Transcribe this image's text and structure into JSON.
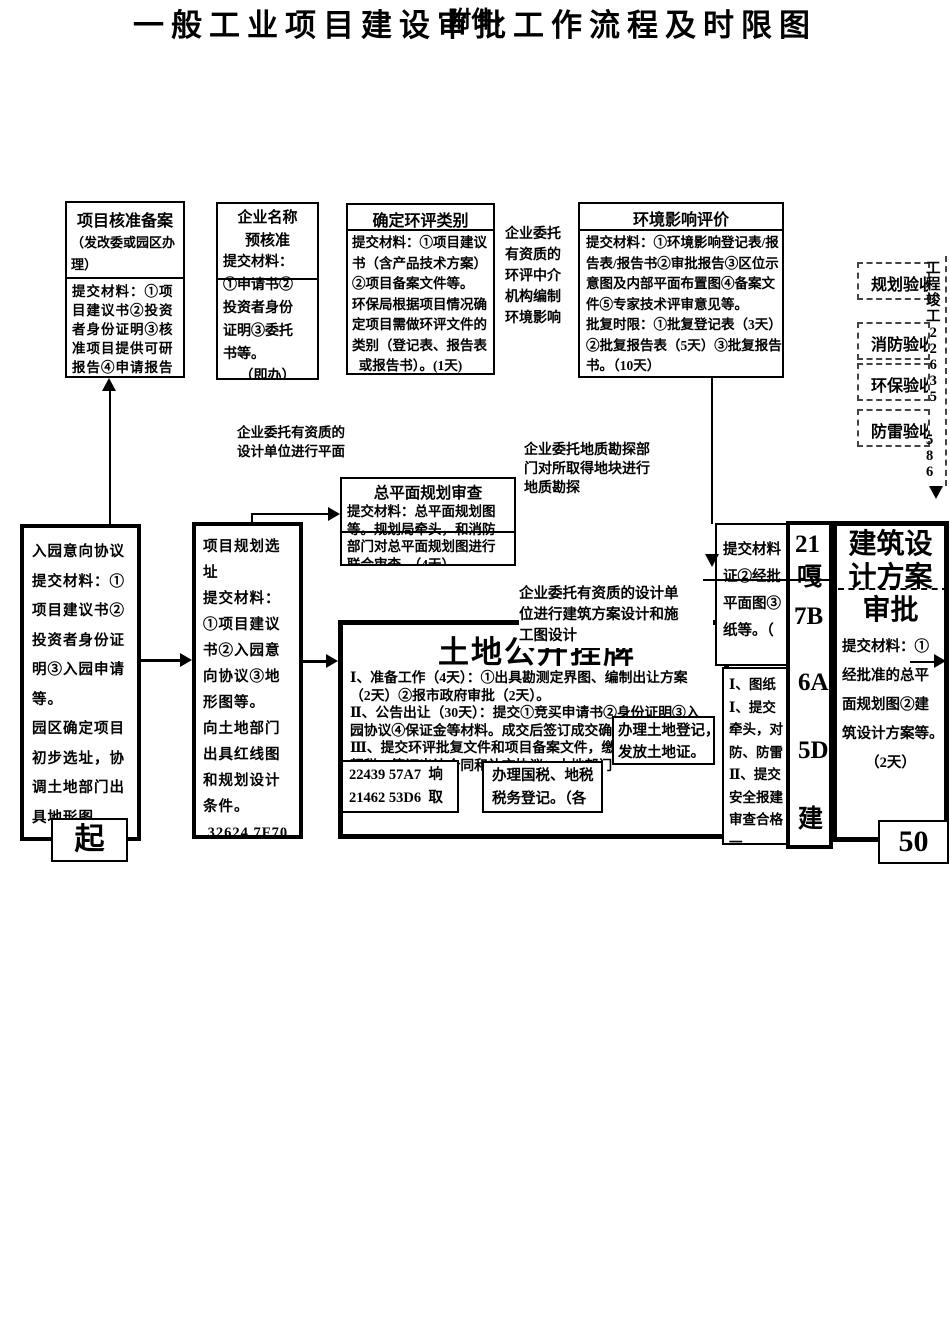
{
  "header": {
    "attachment": "附件:",
    "title": "一般工业项目建设审批工作流程及时限图"
  },
  "top_boxes": {
    "project_record": {
      "title": "项目核准备案",
      "subtitle": "（发改委或园区办\n理）",
      "body": "提交材料：①项\n目建议书②投资\n者身份证明③核\n准项目提供可研\n报告④申请报告"
    },
    "name_precheck": {
      "title": "企业名称\n预核准",
      "label": "提交材料：",
      "body": "①申请书②\n投资者身份\n证明③委托\n书等。",
      "note": "（即办）"
    },
    "eia_category": {
      "title": "确定环评类别",
      "body": "提交材料：①项目建议\n书（含产品技术方案）\n②项目备案文件等。\n环保局根据项目情况确\n定项目需做环评文件的\n类别（登记表、报告表\n  或报告书）。(1天)"
    },
    "eia_review": {
      "title": "环境影响评价",
      "body": "提交材料：①环境影响登记表/报\n告表/报告书②审批报告③区位示\n意图及内部平面布置图④备案文\n件⑤专家技术评审意见等。\n批复时限：①批复登记表（3天）\n②批复报告表（5天）③批复报告\n书。（10天）"
    }
  },
  "notes": {
    "eia_agency": "企业委托\n有资质的\n环评中介\n机构编制\n环境影响",
    "plan_design": "企业委托有资质的\n设计单位进行平面",
    "geo_survey": "企业委托地质勘探部\n门对所取得地块进行\n地质勘探",
    "arch_design": "企业委托有资质的设计单\n位进行建筑方案设计和施\n工图设计"
  },
  "acceptance": {
    "items": [
      "规划验收",
      "消防验收",
      "环保验收",
      "防雷验收"
    ],
    "strip_top": "工\n程\n竣\n工\n2\n2\n6\n3\n5",
    "strip_bottom": "5\n8\n6"
  },
  "mid_boxes": {
    "master_plan": {
      "title": "总平面规划审查",
      "body": "提交材料：总平面规划图\n等。规划局牵头，和消防\n部门对总平面规划图进行\n联合审查。（4天）"
    },
    "park_intent": "入园意向协议\n提交材料：①\n项目建议书②\n投资者身份证\n明③入园申请\n等。\n园区确定项目\n初步选址，协\n调土地部门出\n具地形图。",
    "site_select": "项目规划选\n址\n提交材料：\n①项目建议\n书②入园意\n向协议③地\n形图等。\n向土地部门\n出具红线图\n和规划设计\n条件。\n 32624 7F70"
  },
  "land": {
    "title": "土地公开挂牌",
    "body": "Ⅰ、准备工作（4天）：①出具勘测定界图、编制出让方案\n（2天）②报市政府审批（2天）。\nⅡ、公告出让（30天）：提交①竞买申请书②身份证明③入\n园协议④保证金等材料。成交后签订成交确\nⅢ、提交环评批复文件和项目备案文件，缴\n契税，签订出让合同和补充协议；土地部门\n准书  （1天）",
    "garbled_box": "22439 57A7  垧\n21462 53D6  取",
    "tax_box": "办理国税、地税\n税务登记。（各",
    "land_reg_box": "办理土地登记，\n发放土地证。"
  },
  "right": {
    "col_a": "提交材料\n证②经批\n平面图③\n纸等。（",
    "col_b": "Ⅰ、图纸\nⅠ、提交\n牵头，对\n防、防雷\nⅡ、提交\n安全报建\n审查合格\n一",
    "col_c": [
      "21",
      "嘎",
      "7B",
      "6A",
      "5D",
      "建"
    ],
    "arch": {
      "title": "建筑设\n计方案\n审批",
      "body": "提交材料：①\n经批准的总平\n面规划图②建\n筑设计方案等。",
      "note": "（2天）"
    }
  },
  "flow": {
    "start": "起",
    "end": "50"
  }
}
